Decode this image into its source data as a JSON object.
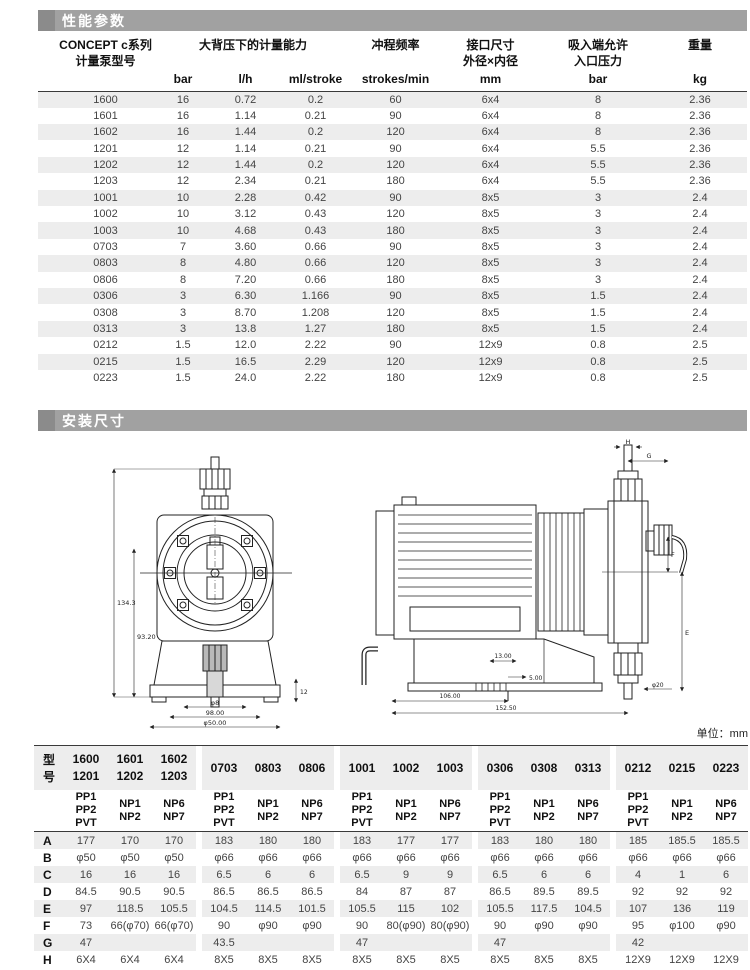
{
  "colors": {
    "section_bar": "#a1a1a1",
    "section_square": "#8b8b8b",
    "row_stripe": "#ededed",
    "line": "#3a3a3a",
    "text_data": "#444444"
  },
  "performance": {
    "title": "性能参数",
    "header": {
      "model_line1": "CONCEPT c系列",
      "model_line2": "计量泵型号",
      "capacity": "大背压下的计量能力",
      "stroke_freq": "冲程频率",
      "conn_line1": "接口尺寸",
      "conn_line2": "外径×内径",
      "suction_line1": "吸入端允许",
      "suction_line2": "入口压力",
      "weight": "重量",
      "units": [
        "bar",
        "l/h",
        "ml/stroke",
        "strokes/min",
        "mm",
        "bar",
        "kg"
      ]
    },
    "rows": [
      [
        "1600",
        "16",
        "0.72",
        "0.2",
        "60",
        "6x4",
        "8",
        "2.36"
      ],
      [
        "1601",
        "16",
        "1.14",
        "0.21",
        "90",
        "6x4",
        "8",
        "2.36"
      ],
      [
        "1602",
        "16",
        "1.44",
        "0.2",
        "120",
        "6x4",
        "8",
        "2.36"
      ],
      [
        "1201",
        "12",
        "1.14",
        "0.21",
        "90",
        "6x4",
        "5.5",
        "2.36"
      ],
      [
        "1202",
        "12",
        "1.44",
        "0.2",
        "120",
        "6x4",
        "5.5",
        "2.36"
      ],
      [
        "1203",
        "12",
        "2.34",
        "0.21",
        "180",
        "6x4",
        "5.5",
        "2.36"
      ],
      [
        "1001",
        "10",
        "2.28",
        "0.42",
        "90",
        "8x5",
        "3",
        "2.4"
      ],
      [
        "1002",
        "10",
        "3.12",
        "0.43",
        "120",
        "8x5",
        "3",
        "2.4"
      ],
      [
        "1003",
        "10",
        "4.68",
        "0.43",
        "180",
        "8x5",
        "3",
        "2.4"
      ],
      [
        "0703",
        "7",
        "3.60",
        "0.66",
        "90",
        "8x5",
        "3",
        "2.4"
      ],
      [
        "0803",
        "8",
        "4.80",
        "0.66",
        "120",
        "8x5",
        "3",
        "2.4"
      ],
      [
        "0806",
        "8",
        "7.20",
        "0.66",
        "180",
        "8x5",
        "3",
        "2.4"
      ],
      [
        "0306",
        "3",
        "6.30",
        "1.166",
        "90",
        "8x5",
        "1.5",
        "2.4"
      ],
      [
        "0308",
        "3",
        "8.70",
        "1.208",
        "120",
        "8x5",
        "1.5",
        "2.4"
      ],
      [
        "0313",
        "3",
        "13.8",
        "1.27",
        "180",
        "8x5",
        "1.5",
        "2.4"
      ],
      [
        "0212",
        "1.5",
        "12.0",
        "2.22",
        "90",
        "12x9",
        "0.8",
        "2.5"
      ],
      [
        "0215",
        "1.5",
        "16.5",
        "2.29",
        "120",
        "12x9",
        "0.8",
        "2.5"
      ],
      [
        "0223",
        "1.5",
        "24.0",
        "2.22",
        "180",
        "12x9",
        "0.8",
        "2.5"
      ]
    ]
  },
  "installation": {
    "title": "安装尺寸",
    "front_view_labels": {
      "height_total": "134.3",
      "height_inner": "93.20",
      "width_inner": "φ8",
      "width_mid": "98.00",
      "width_outer": "φ50.00",
      "foot": "12"
    },
    "side_view_labels": {
      "h": "H",
      "g": "G",
      "e": "E",
      "f": "F",
      "d13": "13.00",
      "d5": "5.00",
      "d106": "106.00",
      "d152": "152.50",
      "phi20": "φ20"
    }
  },
  "dimensions": {
    "unit_note": "单位：mm",
    "row_label_header": "型号",
    "model_groups": [
      [
        [
          "1600",
          "1201"
        ],
        [
          "1601",
          "1202"
        ],
        [
          "1602",
          "1203"
        ]
      ],
      [
        [
          "0703"
        ],
        [
          "0803"
        ],
        [
          "0806"
        ]
      ],
      [
        [
          "1001"
        ],
        [
          "1002"
        ],
        [
          "1003"
        ]
      ],
      [
        [
          "0306"
        ],
        [
          "0308"
        ],
        [
          "0313"
        ]
      ],
      [
        [
          "0212"
        ],
        [
          "0215"
        ],
        [
          "0223"
        ]
      ]
    ],
    "materials": [
      [
        "PP1",
        "PP2",
        "PVT"
      ],
      [
        "NP1",
        "NP2"
      ],
      [
        "NP6",
        "NP7"
      ]
    ],
    "rows": [
      {
        "label": "A",
        "groups": [
          [
            "177",
            "170",
            "170"
          ],
          [
            "183",
            "180",
            "180"
          ],
          [
            "183",
            "177",
            "177"
          ],
          [
            "183",
            "180",
            "180"
          ],
          [
            "185",
            "185.5",
            "185.5"
          ]
        ]
      },
      {
        "label": "B",
        "groups": [
          [
            "φ50",
            "φ50",
            "φ50"
          ],
          [
            "φ66",
            "φ66",
            "φ66"
          ],
          [
            "φ66",
            "φ66",
            "φ66"
          ],
          [
            "φ66",
            "φ66",
            "φ66"
          ],
          [
            "φ66",
            "φ66",
            "φ66"
          ]
        ]
      },
      {
        "label": "C",
        "groups": [
          [
            "16",
            "16",
            "16"
          ],
          [
            "6.5",
            "6",
            "6"
          ],
          [
            "6.5",
            "9",
            "9"
          ],
          [
            "6.5",
            "6",
            "6"
          ],
          [
            "4",
            "1",
            "6"
          ]
        ]
      },
      {
        "label": "D",
        "groups": [
          [
            "84.5",
            "90.5",
            "90.5"
          ],
          [
            "86.5",
            "86.5",
            "86.5"
          ],
          [
            "84",
            "87",
            "87"
          ],
          [
            "86.5",
            "89.5",
            "89.5"
          ],
          [
            "92",
            "92",
            "92"
          ]
        ]
      },
      {
        "label": "E",
        "groups": [
          [
            "97",
            "118.5",
            "105.5"
          ],
          [
            "104.5",
            "114.5",
            "101.5"
          ],
          [
            "105.5",
            "115",
            "102"
          ],
          [
            "105.5",
            "117.5",
            "104.5"
          ],
          [
            "107",
            "136",
            "119"
          ]
        ]
      },
      {
        "label": "F",
        "groups": [
          [
            "73",
            "66(φ70)",
            "66(φ70)"
          ],
          [
            "90",
            "φ90",
            "φ90"
          ],
          [
            "90",
            "80(φ90)",
            "80(φ90)"
          ],
          [
            "90",
            "φ90",
            "φ90"
          ],
          [
            "95",
            "φ100",
            "φ90"
          ]
        ]
      },
      {
        "label": "G",
        "groups": [
          [
            "47",
            "",
            ""
          ],
          [
            "43.5",
            "",
            ""
          ],
          [
            "47",
            "",
            ""
          ],
          [
            "47",
            "",
            ""
          ],
          [
            "42",
            "",
            ""
          ]
        ]
      },
      {
        "label": "H",
        "groups": [
          [
            "6X4",
            "6X4",
            "6X4"
          ],
          [
            "8X5",
            "8X5",
            "8X5"
          ],
          [
            "8X5",
            "8X5",
            "8X5"
          ],
          [
            "8X5",
            "8X5",
            "8X5"
          ],
          [
            "12X9",
            "12X9",
            "12X9"
          ]
        ]
      }
    ]
  }
}
